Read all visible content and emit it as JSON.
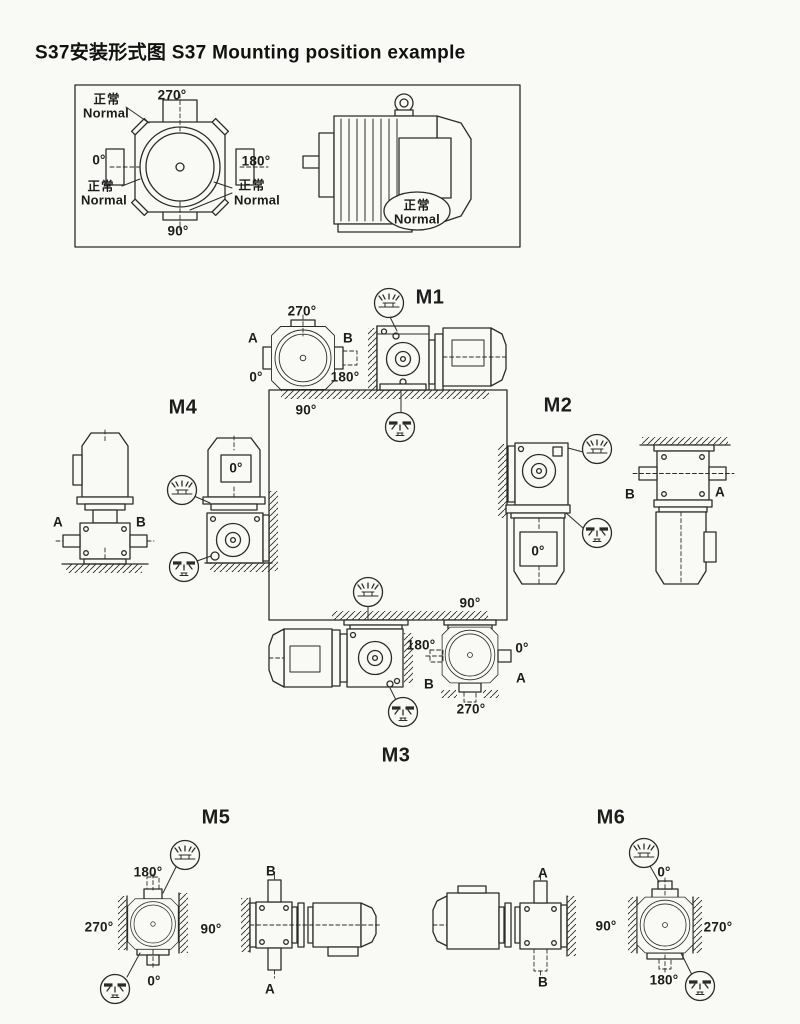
{
  "title": "S37安装形式图  S37 Mounting position example",
  "colors": {
    "ink": "#2b2b2b",
    "paper": "#f9f9f6"
  },
  "icons": {
    "vent": "breather-vent-plug",
    "drain": "oil-drain-plug"
  },
  "legend": {
    "angles": {
      "top": "270°",
      "left": "0°",
      "right": "180°",
      "bottom": "90°"
    },
    "normal": {
      "cn": "正常",
      "en": "Normal"
    }
  },
  "positions": {
    "m1": {
      "label": "M1",
      "shaft_a": "A",
      "shaft_b": "B",
      "angles": {
        "top": "270°",
        "bottom_left": "0°",
        "bottom_right": "180°",
        "bottom": "90°"
      }
    },
    "m2": {
      "label": "M2",
      "motor_angle": "0°",
      "shaft_b": "B",
      "shaft_a": "A"
    },
    "m3": {
      "label": "M3",
      "shaft_b": "B",
      "shaft_a": "A",
      "angles": {
        "top": "90°",
        "left": "180°",
        "right": "0°",
        "bottom": "270°"
      }
    },
    "m4": {
      "label": "M4",
      "shaft_a": "A",
      "shaft_b": "B",
      "motor_angle": "0°"
    },
    "m5": {
      "label": "M5",
      "shaft_b": "B",
      "shaft_a": "A",
      "angles": {
        "top": "180°",
        "left": "270°",
        "right": "90°",
        "bottom": "0°"
      }
    },
    "m6": {
      "label": "M6",
      "shaft_a": "A",
      "shaft_b": "B",
      "angles": {
        "top": "0°",
        "left": "90°",
        "right": "270°",
        "bottom": "180°"
      }
    }
  }
}
